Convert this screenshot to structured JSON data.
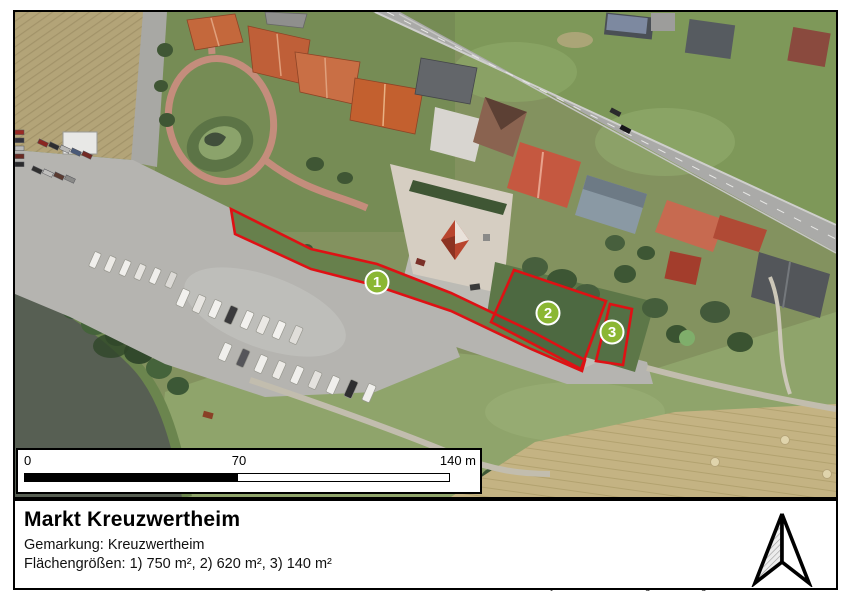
{
  "map": {
    "markers": [
      {
        "number": "1"
      },
      {
        "number": "2"
      },
      {
        "number": "3"
      }
    ],
    "marker_fill": "#8bb733",
    "parcel_outline_color": "#de1114"
  },
  "scale_bar": {
    "start": "0",
    "middle": "70",
    "end": "140 m"
  },
  "title_block": {
    "title": "Markt Kreuzwertheim",
    "line_gemarkung": "Gemarkung: Kreuzwertheim",
    "line_areas": "Flächengrößen: 1) 750 m², 2) 620 m², 3) 140 m²",
    "copyright": "© Bayerische Vermessungsverwaltung 2018"
  }
}
